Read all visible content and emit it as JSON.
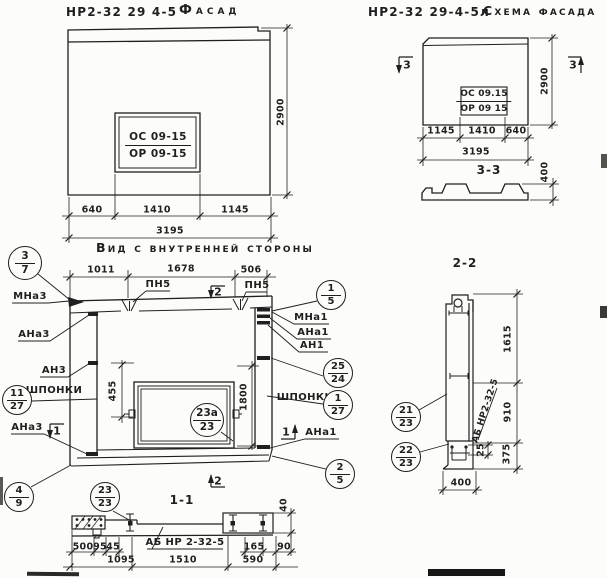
{
  "colors": {
    "ink": "#1f1f1f",
    "paper": "#fcfcfa"
  },
  "facade": {
    "title_code": "НР2-32 29 4-5",
    "title_text": "Фасад",
    "window_mark": {
      "num": "ОС 09-15",
      "den": "ОР 09-15"
    },
    "dims_bottom": [
      "640",
      "1410",
      "1145"
    ],
    "dim_total": "3195",
    "dim_height": "2900"
  },
  "schema": {
    "title_code": "НР2-32 29-4-5л",
    "title_text": "Схема фасада",
    "window_mark": {
      "num": "ОС 09.15",
      "den": "ОР 09 15"
    },
    "dims_bottom": [
      "1145",
      "1410",
      "640"
    ],
    "dim_total": "3195",
    "dim_height": "2900",
    "flag_left": "3",
    "flag_right": "3"
  },
  "section33": {
    "title": "3-3",
    "dim_height": "400"
  },
  "inner": {
    "title": "Вид с внутренней стороны",
    "dims_top": [
      "1011",
      "1678",
      "506"
    ],
    "pn5_left": "ПН5",
    "pn5_right": "ПН5",
    "flag_top": "2",
    "flag_bottom": "2",
    "flag_left": "1",
    "flag_right": "1",
    "dim_455": "455",
    "dim_1800": "1800",
    "labels_left": [
      "МНа3",
      "АНа3",
      "АН3",
      "ШПОНКИ",
      "АНа3"
    ],
    "labels_right": [
      "МНа1",
      "АНа1",
      "АН1",
      "ШПОНКИ",
      "АНа1"
    ],
    "callouts": [
      {
        "top": "3",
        "bottom": "7"
      },
      {
        "top": "1",
        "bottom": "5"
      },
      {
        "top": "25",
        "bottom": "24"
      },
      {
        "top": "1",
        "bottom": "27"
      },
      {
        "top": "11",
        "bottom": "27"
      },
      {
        "top": "23а",
        "bottom": "23"
      },
      {
        "top": "4",
        "bottom": "9"
      },
      {
        "top": "23",
        "bottom": "23"
      },
      {
        "top": "2",
        "bottom": "5"
      }
    ]
  },
  "section11": {
    "title": "1-1",
    "label": "АБ НР 2-32-5",
    "dim_40": "40",
    "dims_row1": [
      "500",
      "95",
      "45",
      "165",
      "90"
    ],
    "dims_row2": [
      "1095",
      "1510",
      "590"
    ]
  },
  "section22": {
    "title": "2-2",
    "label": "АБ НР2-32-5",
    "dim_1615": "1615",
    "dim_910": "910",
    "dim_375": "375",
    "dim_25": "25",
    "dim_400": "400",
    "callouts": [
      {
        "top": "21",
        "bottom": "23"
      },
      {
        "top": "22",
        "bottom": "23"
      }
    ]
  }
}
